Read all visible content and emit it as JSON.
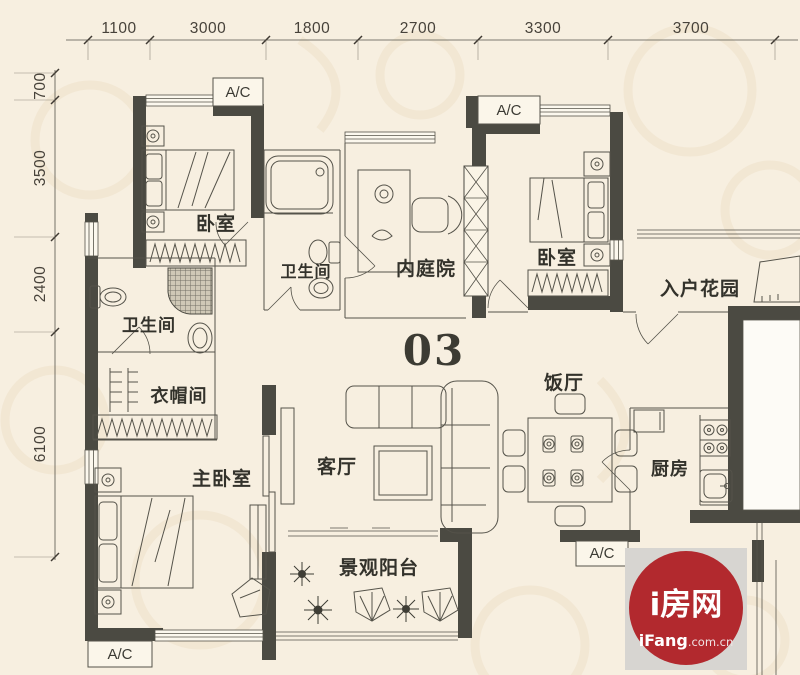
{
  "unit_number": "03",
  "dimensions": {
    "top": [
      "1100",
      "3000",
      "1800",
      "2700",
      "3300",
      "3700"
    ],
    "left": [
      "700",
      "3500",
      "2400",
      "6100"
    ]
  },
  "rooms": {
    "bedroom_top_left": "卧室",
    "bathroom_middle": "卫生间",
    "courtyard": "内庭院",
    "bedroom_top_right": "卧室",
    "entry_garden": "入户花园",
    "bathroom_left": "卫生间",
    "cloakroom": "衣帽间",
    "master_bedroom": "主卧室",
    "living_room": "客厅",
    "dining_room": "饭厅",
    "kitchen": "厨房",
    "balcony": "景观阳台"
  },
  "ac_units": [
    "A/C",
    "A/C",
    "A/C",
    "A/C"
  ],
  "logo": {
    "brand": "i房网",
    "domain": "iFang",
    "domain_suffix": ".com.cn",
    "brand_color": "#b2292e",
    "box_color": "#d7d5d1"
  },
  "colors": {
    "wall": "#4b4a42",
    "paper": "#f7efe0"
  }
}
